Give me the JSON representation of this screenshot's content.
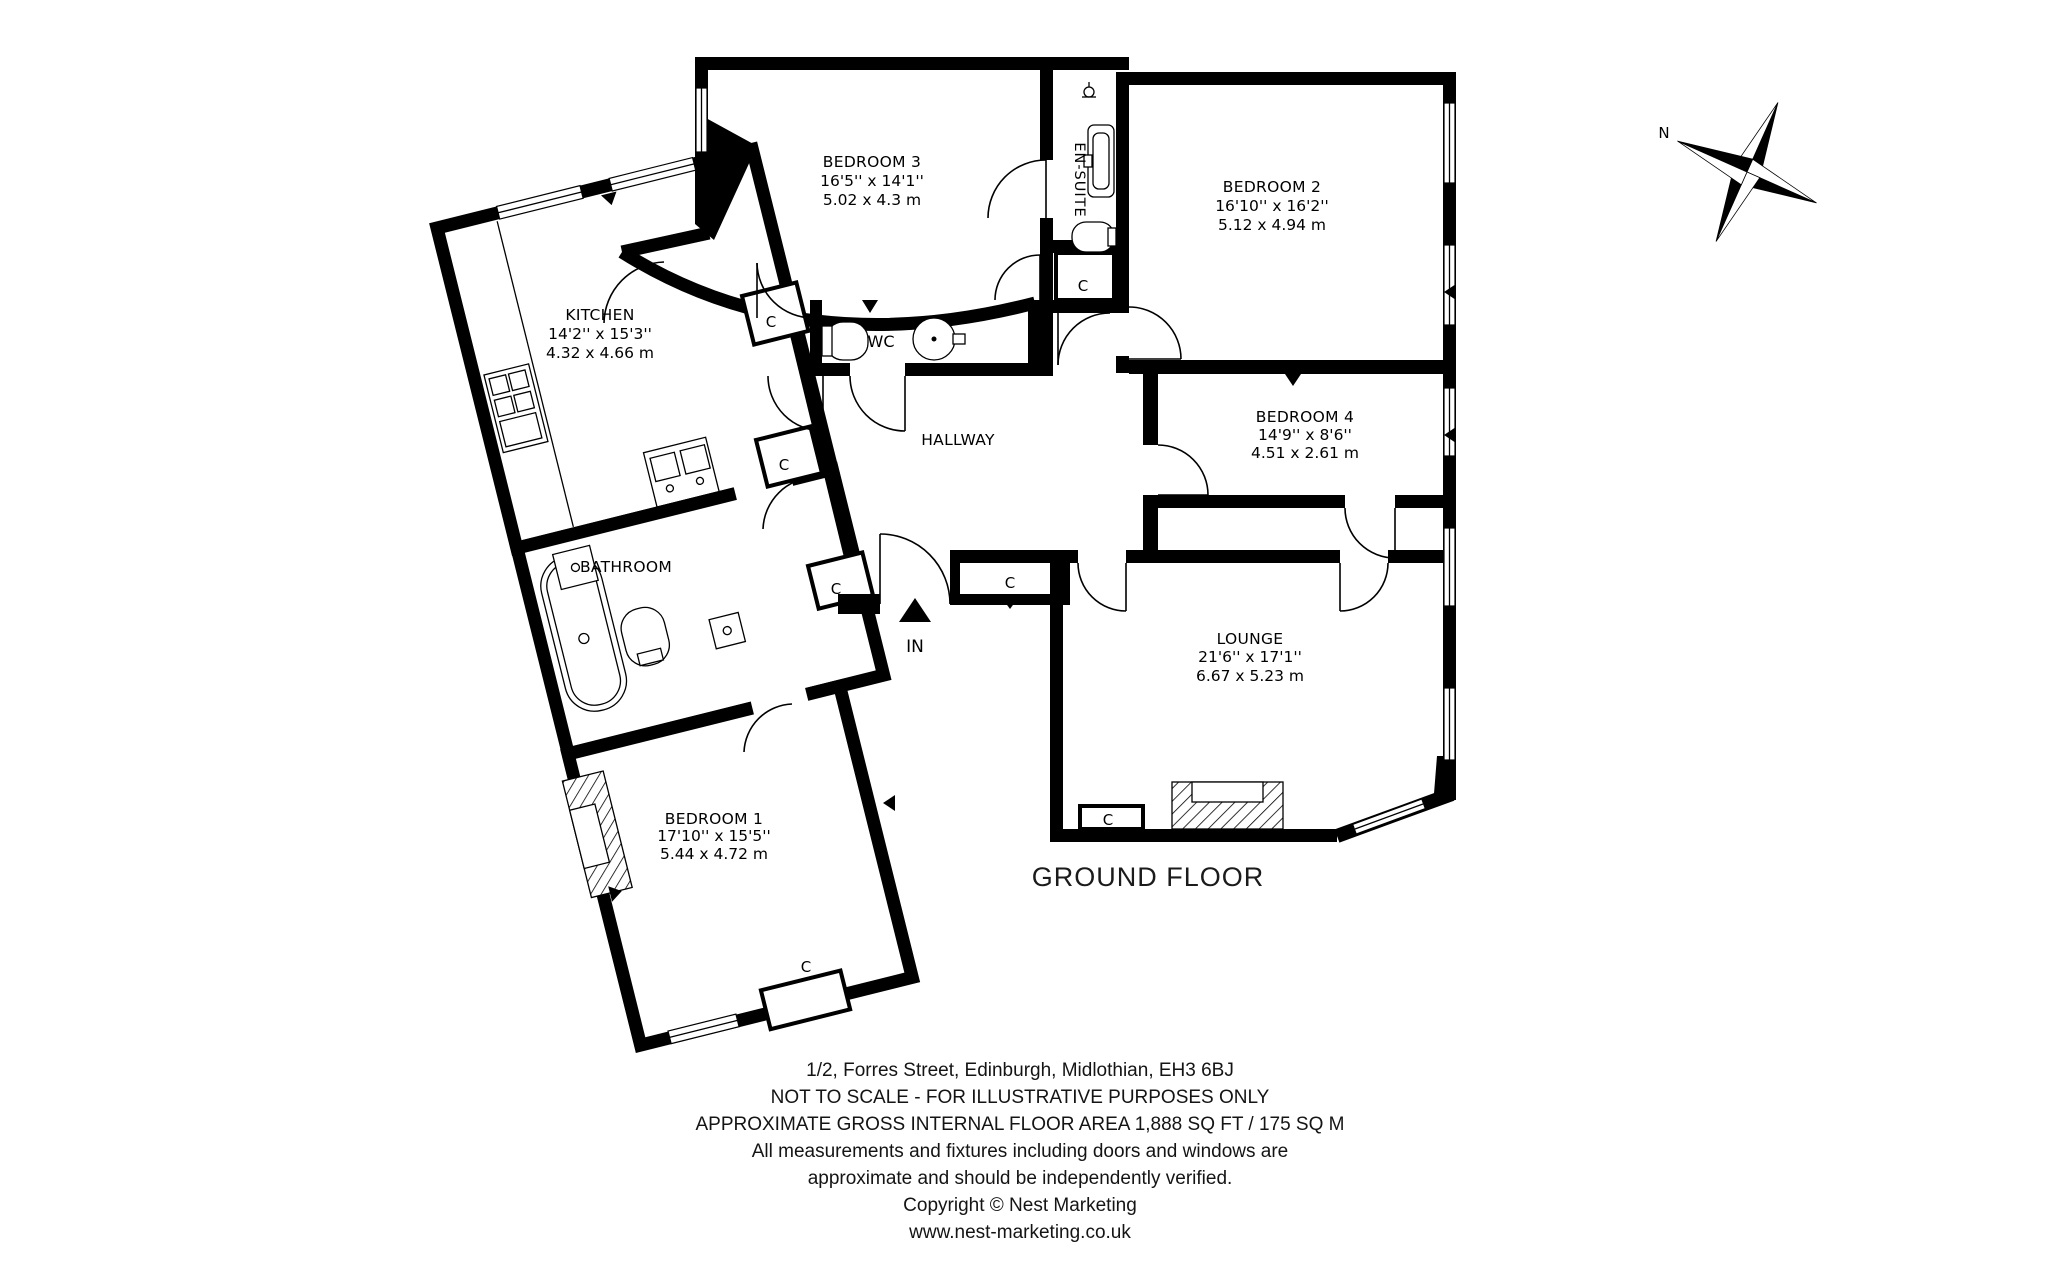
{
  "floor_title": "GROUND FLOOR",
  "compass": {
    "north_label": "N"
  },
  "entrance": {
    "label": "IN"
  },
  "labels": {
    "closet": "C",
    "wc": "WC",
    "hallway": "HALLWAY",
    "bathroom": "BATHROOM",
    "ensuite": "EN-SUITE"
  },
  "rooms": {
    "bedroom3": {
      "name": "BEDROOM 3",
      "imperial": "16'5'' x 14'1''",
      "metric": "5.02 x 4.3 m"
    },
    "bedroom2": {
      "name": "BEDROOM 2",
      "imperial": "16'10'' x 16'2''",
      "metric": "5.12 x 4.94 m"
    },
    "kitchen": {
      "name": "KITCHEN",
      "imperial": "14'2'' x 15'3''",
      "metric": "4.32 x 4.66 m"
    },
    "bedroom4": {
      "name": "BEDROOM 4",
      "imperial": "14'9'' x 8'6''",
      "metric": "4.51 x 2.61 m"
    },
    "lounge": {
      "name": "LOUNGE",
      "imperial": "21'6'' x 17'1''",
      "metric": "6.67 x 5.23 m"
    },
    "bedroom1": {
      "name": "BEDROOM 1",
      "imperial": "17'10'' x 15'5''",
      "metric": "5.44 x 4.72 m"
    }
  },
  "footer": {
    "lines": [
      "1/2, Forres Street, Edinburgh, Midlothian, EH3 6BJ",
      "NOT TO SCALE - FOR ILLUSTRATIVE PURPOSES ONLY",
      "APPROXIMATE GROSS INTERNAL FLOOR AREA 1,888 SQ FT / 175 SQ M",
      "All measurements and fixtures including doors and windows are",
      "approximate and should be independently verified.",
      "Copyright © Nest Marketing",
      "www.nest-marketing.co.uk"
    ]
  },
  "colors": {
    "ink": "#000000",
    "paper": "#ffffff"
  }
}
